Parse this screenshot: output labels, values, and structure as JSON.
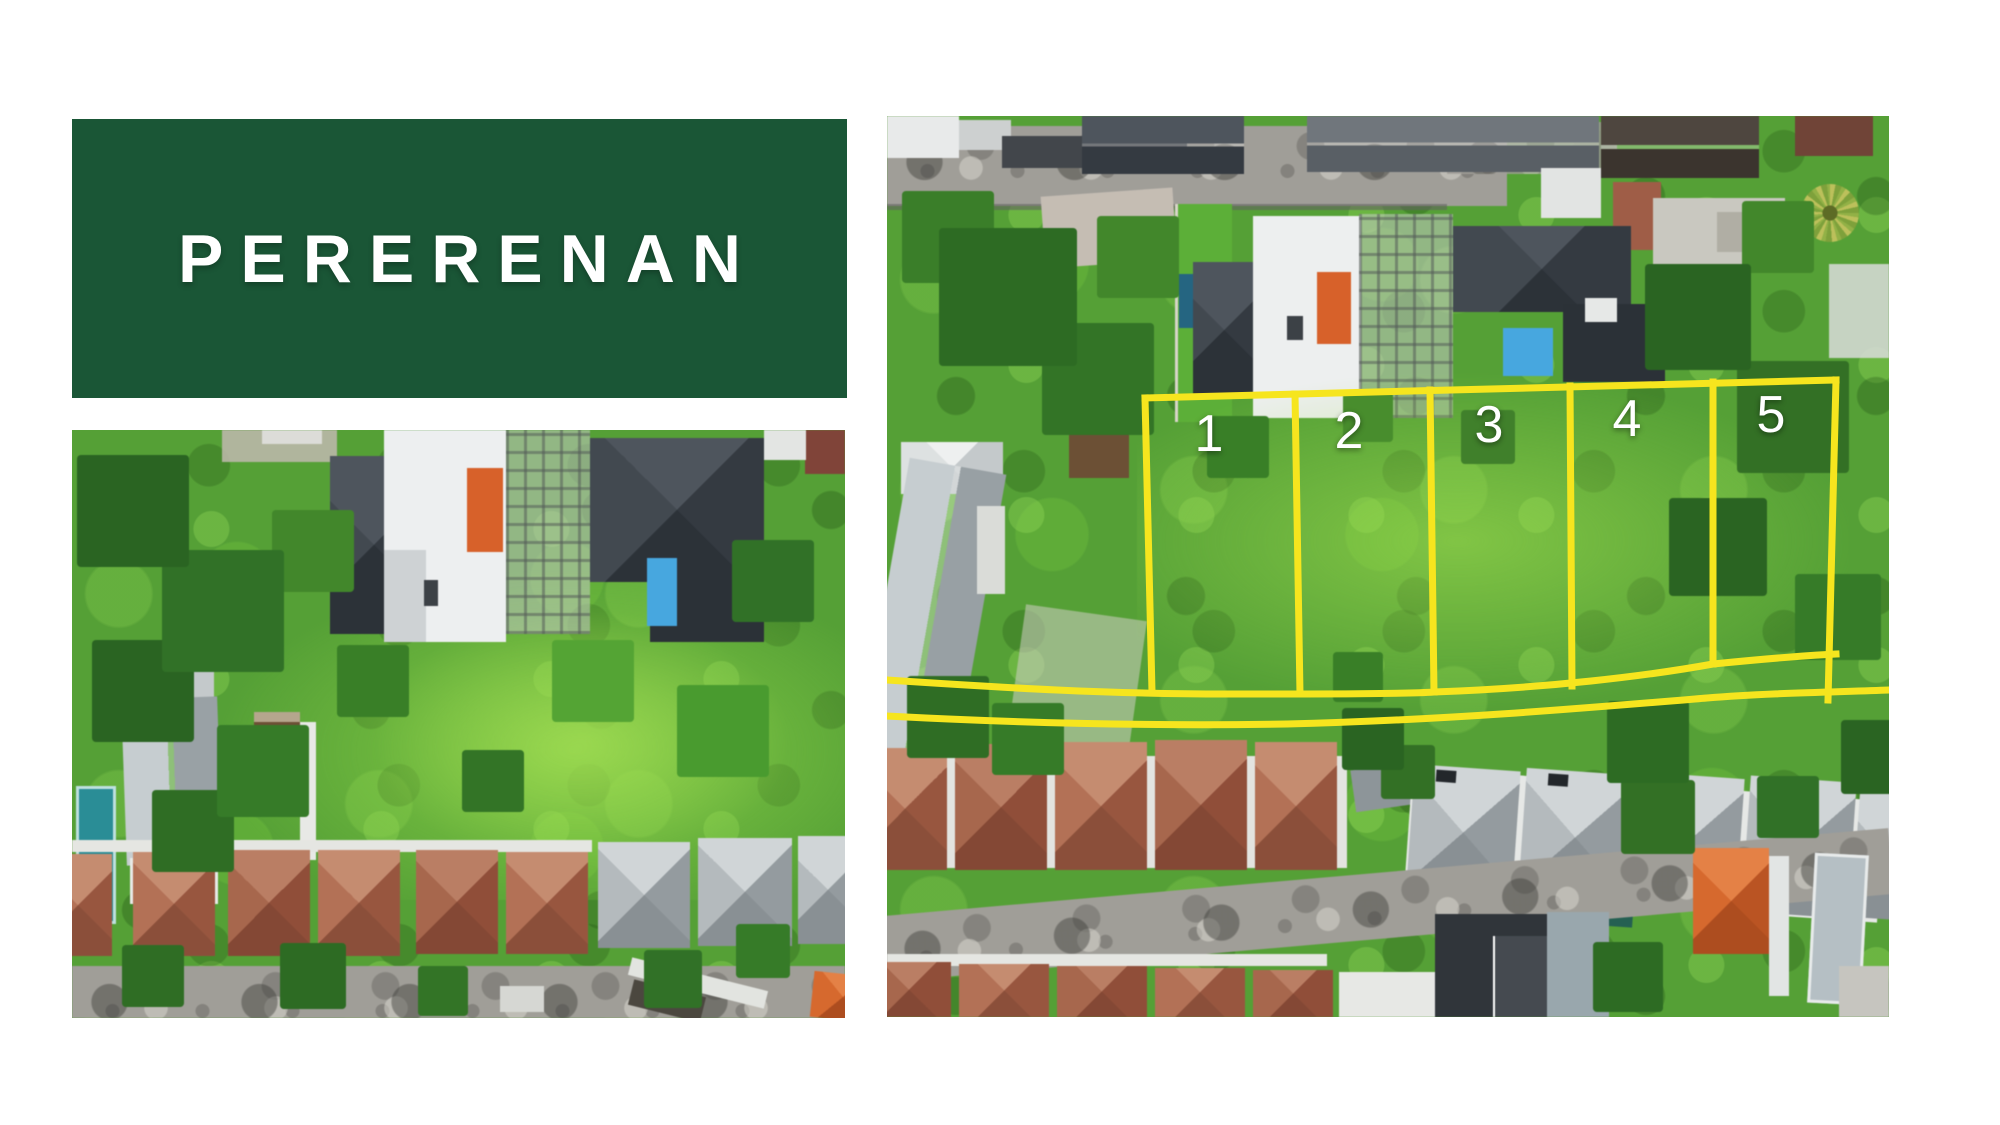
{
  "banner": {
    "title": "PERERENAN",
    "background_color": "#1A5636",
    "text_color": "#FFFFFF"
  },
  "right_photo": {
    "plot_labels": [
      "1",
      "2",
      "3",
      "4",
      "5"
    ],
    "plot_outline_color": "#F6E51E",
    "plot_label_color": "#FFFFFF"
  }
}
